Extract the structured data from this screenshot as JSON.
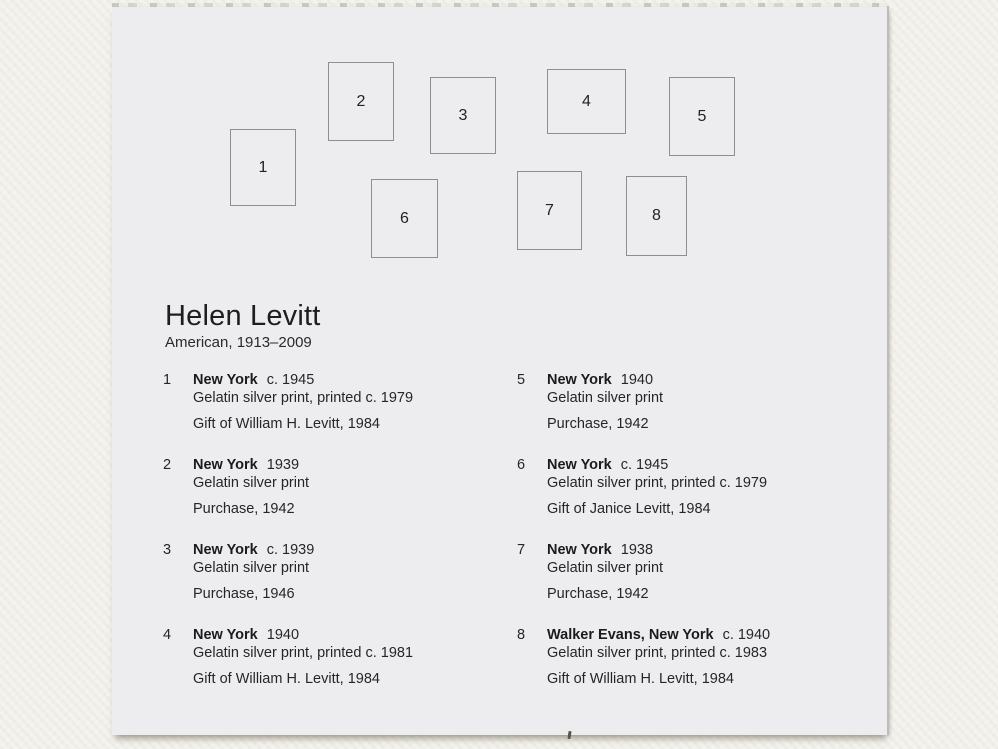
{
  "card": {
    "artist": "Helen Levitt",
    "artist_dates": "American, 1913–2009",
    "diagram_boxes": [
      {
        "num": "1",
        "x": 118,
        "y": 123,
        "w": 66,
        "h": 77
      },
      {
        "num": "2",
        "x": 216,
        "y": 56,
        "w": 66,
        "h": 79
      },
      {
        "num": "3",
        "x": 318,
        "y": 71,
        "w": 66,
        "h": 77
      },
      {
        "num": "4",
        "x": 435,
        "y": 63,
        "w": 79,
        "h": 65
      },
      {
        "num": "5",
        "x": 557,
        "y": 71,
        "w": 66,
        "h": 79
      },
      {
        "num": "6",
        "x": 259,
        "y": 173,
        "w": 67,
        "h": 79
      },
      {
        "num": "7",
        "x": 405,
        "y": 165,
        "w": 65,
        "h": 79
      },
      {
        "num": "8",
        "x": 514,
        "y": 170,
        "w": 61,
        "h": 80
      }
    ],
    "entries": [
      {
        "num": "1",
        "column": "left",
        "title": "New York",
        "date": "c. 1945",
        "medium": "Gelatin silver print, printed c. 1979",
        "credit": "Gift of William H. Levitt, 1984"
      },
      {
        "num": "2",
        "column": "left",
        "title": "New York",
        "date": "1939",
        "medium": "Gelatin silver print",
        "credit": "Purchase, 1942"
      },
      {
        "num": "3",
        "column": "left",
        "title": "New York",
        "date": "c. 1939",
        "medium": "Gelatin silver print",
        "credit": "Purchase, 1946"
      },
      {
        "num": "4",
        "column": "left",
        "title": "New York",
        "date": "1940",
        "medium": "Gelatin silver print, printed c. 1981",
        "credit": "Gift of William H. Levitt, 1984"
      },
      {
        "num": "5",
        "column": "right",
        "title": "New York",
        "date": "1940",
        "medium": "Gelatin silver print",
        "credit": "Purchase, 1942"
      },
      {
        "num": "6",
        "column": "right",
        "title": "New York",
        "date": "c. 1945",
        "medium": "Gelatin silver print, printed c. 1979",
        "credit": "Gift of Janice Levitt, 1984"
      },
      {
        "num": "7",
        "column": "right",
        "title": "New York",
        "date": "1938",
        "medium": "Gelatin silver print",
        "credit": "Purchase, 1942"
      },
      {
        "num": "8",
        "column": "right",
        "title": "Walker Evans, New York",
        "date": "c. 1940",
        "medium": "Gelatin silver print, printed c. 1983",
        "credit": "Gift of William H. Levitt, 1984"
      }
    ]
  },
  "colors": {
    "wall": "#f2f1ec",
    "card": "#edecee",
    "text": "#222226",
    "box_border": "#8f8f8f"
  }
}
